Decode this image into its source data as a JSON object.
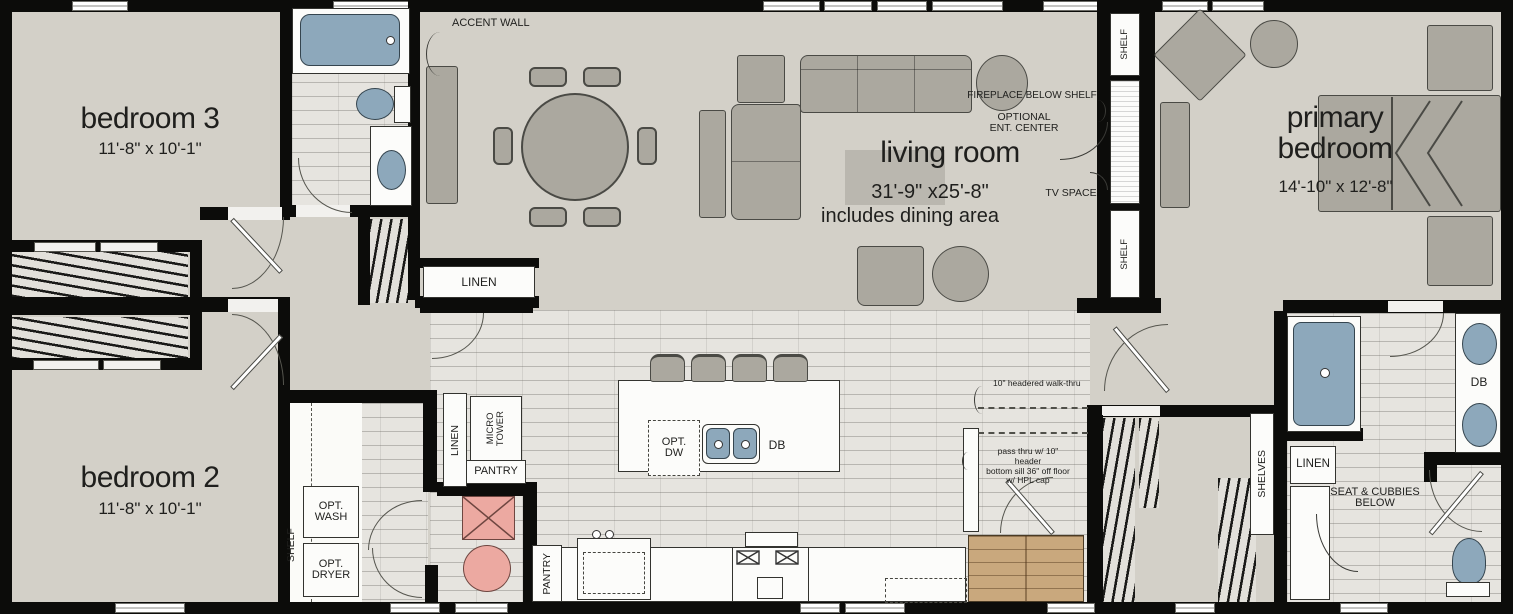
{
  "rooms": {
    "bedroom3": {
      "name": "bedroom 3",
      "dims": "11'-8\" x 10'-1\""
    },
    "bedroom2": {
      "name": "bedroom 2",
      "dims": "11'-8\" x 10'-1\""
    },
    "living_room": {
      "name": "living room",
      "dims": "31'-9\" x25'-8\"",
      "note": "includes dining area"
    },
    "primary_bedroom": {
      "name": "primary\nbedroom",
      "dims": "14'-10\" x 12'-8\""
    }
  },
  "labels": {
    "accent_wall": "ACCENT WALL",
    "fireplace": "FIREPLACE BELOW SHELF",
    "optional_ent": "OPTIONAL\nENT. CENTER",
    "tv_space": "TV SPACE",
    "shelf": "SHELF",
    "linen": "LINEN",
    "micro_tower": "MICRO\nTOWER",
    "pantry": "PANTRY",
    "opt_wash": "OPT.\nWASH",
    "opt_dryer": "OPT.\nDRYER",
    "opt_dw": "OPT.\nDW",
    "db": "DB",
    "shelves": "SHELVES",
    "seat_cubbies": "SEAT & CUBBIES\nBELOW",
    "walk_thru": "10\" headered walk-thru",
    "pass_thru": "pass thru w/ 10\" header\nbottom sill 36\" off floor\nw/ HPL cap"
  },
  "colors": {
    "wall": "#0c0c0a",
    "floor": "#d3d0c8",
    "tile": "#e6e4df",
    "furniture": "#aba89f",
    "fixture_blue": "#8da8bb",
    "optional_pink": "#eca9a1",
    "wood": "#c9a87d"
  }
}
